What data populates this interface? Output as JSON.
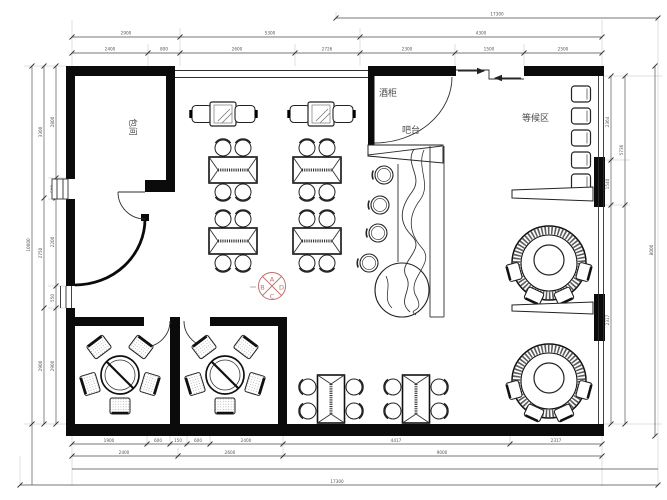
{
  "labels": {
    "private_room": "包间",
    "wine_cabinet": "酒柜",
    "bar_counter": "吧台",
    "waiting_area": "等候区"
  },
  "compass": {
    "top": "A",
    "left": "B",
    "bottom": "C",
    "right": "D",
    "color": "#c0706a"
  },
  "dims": {
    "top": {
      "outer": "17300",
      "row1": [
        "2900",
        "5300",
        "4300"
      ],
      "row2": [
        "2400",
        "800",
        "2600",
        "2726",
        "2300",
        "1500",
        "2500"
      ]
    },
    "left": {
      "outer": "10000",
      "mid": [
        "3300",
        "2750",
        "2900"
      ],
      "inner": [
        "2800",
        "500",
        "2200",
        "550",
        "2900"
      ]
    },
    "right": {
      "col_a": [
        "2364",
        "1540",
        "2317"
      ],
      "col_b": [
        "5736"
      ],
      "outer": "8000"
    },
    "bottom": {
      "row1": [
        "1900",
        "600",
        "150",
        "600",
        "2400",
        "4417",
        "2317"
      ],
      "row2": [
        "2400",
        "2600",
        "9000"
      ],
      "outer": "17300"
    }
  },
  "colors": {
    "wall": "#0b0b0b",
    "line": "#2e2e2e",
    "dim": "#555555",
    "accent": "#c0706a"
  }
}
